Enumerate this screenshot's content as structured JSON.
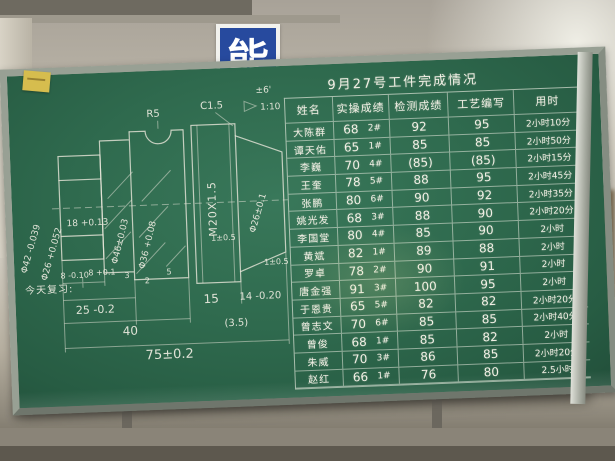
{
  "scene": {
    "poster_char": "能",
    "board_green": "#2f6a4e",
    "frame_color": "#98a094",
    "chalk_color": "#f1efe5",
    "note_color": "#d6bd4e"
  },
  "table": {
    "title": "9月27号工件完成情况",
    "headers": {
      "name": "姓名",
      "practical": "实操成绩",
      "inspect": "检测成绩",
      "process": "工艺编写",
      "time": "用时"
    },
    "rows": [
      {
        "name": "大陈群",
        "score": "68",
        "machine": "2#",
        "inspect": "92",
        "process": "95",
        "time": "2小时10分"
      },
      {
        "name": "谭天佑",
        "score": "65",
        "machine": "1#",
        "inspect": "85",
        "process": "85",
        "time": "2小时50分"
      },
      {
        "name": "李巍",
        "score": "70",
        "machine": "4#",
        "inspect": "(85)",
        "process": "(85)",
        "time": "2小时15分"
      },
      {
        "name": "王奎",
        "score": "78",
        "machine": "5#",
        "inspect": "88",
        "process": "95",
        "time": "2小时45分"
      },
      {
        "name": "张鹏",
        "score": "80",
        "machine": "6#",
        "inspect": "90",
        "process": "92",
        "time": "2小时35分"
      },
      {
        "name": "姚光发",
        "score": "68",
        "machine": "3#",
        "inspect": "88",
        "process": "90",
        "time": "2小时20分"
      },
      {
        "name": "李国堂",
        "score": "80",
        "machine": "4#",
        "inspect": "85",
        "process": "90",
        "time": "2小时"
      },
      {
        "name": "黄斌",
        "score": "82",
        "machine": "1#",
        "inspect": "89",
        "process": "88",
        "time": "2小时"
      },
      {
        "name": "罗卓",
        "score": "78",
        "machine": "2#",
        "inspect": "90",
        "process": "91",
        "time": "2小时"
      },
      {
        "name": "唐金强",
        "score": "91",
        "machine": "3#",
        "inspect": "100",
        "process": "95",
        "time": "2小时"
      },
      {
        "name": "于恩贵",
        "score": "65",
        "machine": "5#",
        "inspect": "82",
        "process": "82",
        "time": "2小时20分"
      },
      {
        "name": "曾志文",
        "score": "70",
        "machine": "6#",
        "inspect": "85",
        "process": "85",
        "time": "2小时40分"
      },
      {
        "name": "曾俊",
        "score": "68",
        "machine": "1#",
        "inspect": "85",
        "process": "82",
        "time": "2小时"
      },
      {
        "name": "朱威",
        "score": "70",
        "machine": "3#",
        "inspect": "86",
        "process": "85",
        "time": "2小时20分"
      },
      {
        "name": "赵红",
        "score": "66",
        "machine": "1#",
        "inspect": "76",
        "process": "80",
        "time": "2.5小时"
      }
    ]
  },
  "diagram": {
    "note": "今天复习:",
    "labels": {
      "phi42": "Φ42 -0.039",
      "phi26": "Φ26 +0.052",
      "d18": "18 +0.13",
      "r5": "R5",
      "c15": "C1.5",
      "taper_tol": "±6'",
      "taper": "1:10",
      "phi46": "Φ46±0.03",
      "phi36": "Φ36 +0.08",
      "thread": "M20X1.5",
      "phi26b": "Φ26±0.1",
      "one_tol_a": "1±0.5",
      "one_tol_b": "1±0.5",
      "d8a": "8 -0.10",
      "d8b": "8 +0.1",
      "d3": "3",
      "d2": "2",
      "d5": "5",
      "d25": "25 -0.2",
      "d15": "15",
      "d14": "14 -0.20",
      "d40": "40",
      "d35": "(3.5)",
      "d75": "75±0.2"
    }
  }
}
